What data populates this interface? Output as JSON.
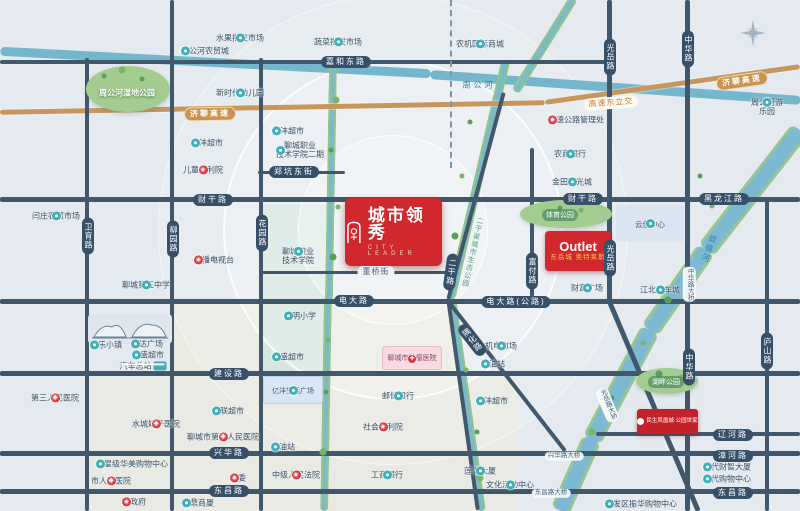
{
  "project": {
    "name": "城市领秀",
    "subtitle_en": "CITY LEADER"
  },
  "badges": {
    "outlet": {
      "line1": "Outlet",
      "line2": "东岳城 奥特莱斯"
    },
    "minsheng": {
      "text": "民生凤凰城·公园世家"
    },
    "tumor": {
      "text": "聊城市肿瘤医院"
    },
    "yifeng_plaza": {
      "text": "亿沣生活广场"
    },
    "yunchuang": {
      "text": "云创中心"
    }
  },
  "colors": {
    "badge_red": "#d0282d",
    "road": "#41586c",
    "water": "#74b6cb",
    "river_bank": "#96c691",
    "expressway": "#c7965c",
    "capsule": "#36506a",
    "poi_teal": "#3fb0b8",
    "poi_red": "#d8353d"
  },
  "road_labels": [
    {
      "t": "嘉和东路",
      "x": 346,
      "y": 62,
      "k": "road-h"
    },
    {
      "t": "济聊高速",
      "x": 210,
      "y": 114,
      "k": "hwy",
      "r": -1
    },
    {
      "t": "济聊高速",
      "x": 742,
      "y": 81,
      "k": "hwy",
      "r": -8
    },
    {
      "t": "高速东立交",
      "x": 611,
      "y": 103,
      "k": "hwyl",
      "r": -4
    },
    {
      "t": "财干路",
      "x": 213,
      "y": 200,
      "k": "road-h"
    },
    {
      "t": "财干路",
      "x": 583,
      "y": 199,
      "k": "road-h"
    },
    {
      "t": "黑龙江路",
      "x": 724,
      "y": 199,
      "k": "road-h"
    },
    {
      "t": "郑坑东街",
      "x": 294,
      "y": 172,
      "k": "road-h"
    },
    {
      "t": "卫育路",
      "x": 88,
      "y": 236,
      "k": "road-v"
    },
    {
      "t": "柳园路",
      "x": 173,
      "y": 239,
      "k": "road-v"
    },
    {
      "t": "花园路",
      "x": 262,
      "y": 233,
      "k": "road-v"
    },
    {
      "t": "二干路",
      "x": 451,
      "y": 272,
      "k": "road-v",
      "r": 8
    },
    {
      "t": "富付路",
      "x": 532,
      "y": 271,
      "k": "road-v"
    },
    {
      "t": "光岳路",
      "x": 610,
      "y": 57,
      "k": "road-v"
    },
    {
      "t": "光岳路",
      "x": 610,
      "y": 258,
      "k": "road-v"
    },
    {
      "t": "中华路",
      "x": 688,
      "y": 49,
      "k": "road-v"
    },
    {
      "t": "中华路",
      "x": 689,
      "y": 367,
      "k": "road-v"
    },
    {
      "t": "庐山路",
      "x": 767,
      "y": 351,
      "k": "road-v"
    },
    {
      "t": "隅化路",
      "x": 472,
      "y": 340,
      "k": "road-v",
      "r": -38
    },
    {
      "t": "电大路",
      "x": 354,
      "y": 301,
      "k": "road-h"
    },
    {
      "t": "电大路(公路)",
      "x": 516,
      "y": 302,
      "k": "road-h"
    },
    {
      "t": "董桥街",
      "x": 376,
      "y": 272,
      "k": "street-light"
    },
    {
      "t": "建设路",
      "x": 229,
      "y": 374,
      "k": "road-h"
    },
    {
      "t": "兴华路",
      "x": 229,
      "y": 453,
      "k": "road-h"
    },
    {
      "t": "辽河路",
      "x": 733,
      "y": 435,
      "k": "road-h"
    },
    {
      "t": "漳河路",
      "x": 733,
      "y": 456,
      "k": "road-h"
    },
    {
      "t": "东昌路",
      "x": 229,
      "y": 491,
      "k": "road-h"
    },
    {
      "t": "东昌路",
      "x": 733,
      "y": 493,
      "k": "road-h"
    },
    {
      "t": "中华路大桥",
      "x": 689,
      "y": 284,
      "k": "bridge-v"
    },
    {
      "t": "光岳路大桥",
      "x": 607,
      "y": 405,
      "k": "bridge-v",
      "r": -23
    },
    {
      "t": "兴华路大桥",
      "x": 564,
      "y": 456,
      "k": "bridge-h"
    },
    {
      "t": "东昌路大桥",
      "x": 551,
      "y": 493,
      "k": "bridge-h"
    }
  ],
  "area_labels": [
    {
      "t": "周公河湿地公园",
      "x": 127,
      "y": 93,
      "k": "park-name"
    },
    {
      "t": "体育公园",
      "x": 560,
      "y": 215,
      "k": "park-capsule"
    },
    {
      "t": "湖畔公园",
      "x": 666,
      "y": 382,
      "k": "park-capsule"
    },
    {
      "t": "周公河",
      "x": 479,
      "y": 85,
      "k": "water-h"
    },
    {
      "t": "徒骇河",
      "x": 709,
      "y": 249,
      "k": "water-v",
      "r": 20
    },
    {
      "t": "二干渠城市生态公园",
      "x": 472,
      "y": 252,
      "k": "water-v-sm",
      "r": 13
    }
  ],
  "pois": [
    {
      "id": "zhougonghe-agritrade",
      "t": "周公河农贸城",
      "icon": "teal",
      "ip": "left",
      "x": 205,
      "y": 51
    },
    {
      "id": "fruit-wholesale-market",
      "t": "水果批发市场",
      "icon": "teal",
      "ip": "above",
      "x": 240,
      "y": 38
    },
    {
      "id": "vegetable-wholesale-market",
      "t": "蔬菜批发市场",
      "icon": "teal",
      "ip": "above",
      "x": 338,
      "y": 42
    },
    {
      "id": "agri-machinery-mall",
      "t": "农机国际商城",
      "icon": "teal",
      "ip": "above",
      "x": 480,
      "y": 44
    },
    {
      "id": "new-era-kindergarten",
      "t": "新时代幼儿园",
      "icon": "teal",
      "ip": "above",
      "x": 240,
      "y": 93
    },
    {
      "id": "yifeng-supermarket-north",
      "t": "亿沣超市",
      "icon": "teal",
      "ip": "left",
      "x": 207,
      "y": 143
    },
    {
      "id": "children-welfare-institute",
      "t": "儿童福利院",
      "icon": "red-star",
      "ip": "above",
      "x": 203,
      "y": 170
    },
    {
      "id": "yifeng-supermarket-west",
      "t": "亿沣超市",
      "icon": "teal",
      "ip": "left",
      "x": 288,
      "y": 131
    },
    {
      "id": "vocational-college-phase2",
      "t": "聊城职业\n技术学院二期",
      "icon": "teal",
      "ip": "left",
      "x": 300,
      "y": 150
    },
    {
      "id": "yanzhuang-farmers-market",
      "t": "闫庄农贸市场",
      "icon": "teal",
      "ip": "above",
      "x": 56,
      "y": 216
    },
    {
      "id": "highway-admin-office",
      "t": "高速公路管理处",
      "icon": "red-star",
      "ip": "right",
      "x": 576,
      "y": 120
    },
    {
      "id": "rural-commercial-bank",
      "t": "农商银行",
      "icon": "teal",
      "ip": "above",
      "x": 570,
      "y": 154
    },
    {
      "id": "jintian-sunshine-city",
      "t": "金田阳光城",
      "icon": "teal",
      "ip": "above",
      "x": 572,
      "y": 182
    },
    {
      "id": "zhougonghe-funfair",
      "t": "周公河游乐园",
      "icon": "teal",
      "ip": "above",
      "x": 767,
      "y": 107
    },
    {
      "id": "radio-tv-station",
      "t": "广播电视台",
      "icon": "red-star",
      "ip": "left",
      "x": 214,
      "y": 260
    },
    {
      "id": "no5-middle-school",
      "t": "聊城第五中学",
      "icon": "teal",
      "ip": "above",
      "x": 146,
      "y": 285
    },
    {
      "id": "vocational-college",
      "t": "聊城职业\n技术学院",
      "icon": "teal",
      "ip": "above",
      "x": 298,
      "y": 256
    },
    {
      "id": "caifu-plaza",
      "t": "财富广场",
      "icon": "teal",
      "ip": "above",
      "x": 587,
      "y": 288
    },
    {
      "id": "jiangbei-auto-city",
      "t": "江北汽车城",
      "icon": "teal",
      "ip": "above",
      "x": 660,
      "y": 290
    },
    {
      "id": "guangming-primary-school",
      "t": "光明小学",
      "icon": "teal",
      "ip": "left",
      "x": 300,
      "y": 316
    },
    {
      "id": "mech-elec-market",
      "t": "机电市场",
      "icon": "teal",
      "ip": "above",
      "x": 501,
      "y": 346
    },
    {
      "id": "gas-station-east",
      "t": "加油站",
      "icon": "teal",
      "ip": "left",
      "x": 493,
      "y": 364
    },
    {
      "id": "yifeng-supermarket-east",
      "t": "亿沣超市",
      "icon": "teal",
      "ip": "left",
      "x": 492,
      "y": 401
    },
    {
      "id": "huasheng-supermarket-center",
      "t": "华盛超市",
      "icon": "teal",
      "ip": "left",
      "x": 288,
      "y": 357
    },
    {
      "id": "psbc-bank",
      "t": "邮储银行",
      "icon": "teal",
      "ip": "above",
      "x": 398,
      "y": 396
    },
    {
      "id": "social-welfare-institute",
      "t": "社会福利院",
      "icon": "red-star",
      "ip": "above",
      "x": 383,
      "y": 427
    },
    {
      "id": "hualian-supermarket",
      "t": "华联超市",
      "icon": "teal",
      "ip": "left",
      "x": 228,
      "y": 411
    },
    {
      "id": "no4-peoples-hospital",
      "t": "聊城市第四人民医院",
      "icon": "red-cross",
      "ip": "above",
      "x": 223,
      "y": 437
    },
    {
      "id": "joy-town",
      "t": "欢乐小镇",
      "icon": "teal",
      "ip": "left",
      "x": 106,
      "y": 345
    },
    {
      "id": "wanda-plaza",
      "t": "万达广场",
      "icon": "teal",
      "ip": "left",
      "x": 147,
      "y": 344
    },
    {
      "id": "huasheng-supermarket-west",
      "t": "华盛超市",
      "icon": "teal",
      "ip": "left",
      "x": 148,
      "y": 355
    },
    {
      "id": "bus-terminal",
      "t": "汽车总站",
      "icon": "bus",
      "ip": "right",
      "x": 143,
      "y": 366
    },
    {
      "id": "no3-peoples-hospital",
      "t": "第三人民医院",
      "icon": "red-cross",
      "ip": "above",
      "x": 55,
      "y": 398
    },
    {
      "id": "shuicheng-maternity-hospital",
      "t": "水城妇产医院",
      "icon": "red-cross",
      "ip": "above",
      "x": 156,
      "y": 424
    },
    {
      "id": "five-star-huamei-mall",
      "t": "五星级华美购物中心",
      "icon": "teal",
      "ip": "right",
      "x": 132,
      "y": 464
    },
    {
      "id": "city-peoples-hospital",
      "t": "市人民医院",
      "icon": "red-cross",
      "ip": "above",
      "x": 111,
      "y": 481
    },
    {
      "id": "municipal-committee",
      "t": "市委",
      "icon": "red-star",
      "ip": "left",
      "x": 238,
      "y": 478
    },
    {
      "id": "city-government",
      "t": "市政府",
      "icon": "red-star",
      "ip": "left",
      "x": 134,
      "y": 502
    },
    {
      "id": "jinding-mall",
      "t": "金鼎商厦",
      "icon": "teal",
      "ip": "left",
      "x": 198,
      "y": 503
    },
    {
      "id": "intermediate-court",
      "t": "中级人民法院",
      "icon": "red-star",
      "ip": "above",
      "x": 296,
      "y": 475
    },
    {
      "id": "icbc-bank",
      "t": "工商银行",
      "icon": "teal",
      "ip": "above",
      "x": 387,
      "y": 475
    },
    {
      "id": "lianhu-tower",
      "t": "莲湖大厦",
      "icon": "teal",
      "ip": "above",
      "x": 480,
      "y": 471
    },
    {
      "id": "cultural-activity-center",
      "t": "文化活动中心",
      "icon": "teal",
      "ip": "above",
      "x": 510,
      "y": 485
    },
    {
      "id": "dangdai-caizhi-tower",
      "t": "当代财智大厦",
      "icon": "teal",
      "ip": "left",
      "x": 727,
      "y": 467
    },
    {
      "id": "dangdai-shopping-center",
      "t": "当代购物中心",
      "icon": "teal",
      "ip": "left",
      "x": 727,
      "y": 479
    },
    {
      "id": "kaifaqu-zhenhua-mall",
      "t": "开发区振华购物中心",
      "icon": "teal",
      "ip": "left",
      "x": 641,
      "y": 504
    },
    {
      "id": "gas-station-west",
      "t": "加油站",
      "icon": "teal",
      "ip": "left",
      "x": 283,
      "y": 447
    }
  ]
}
